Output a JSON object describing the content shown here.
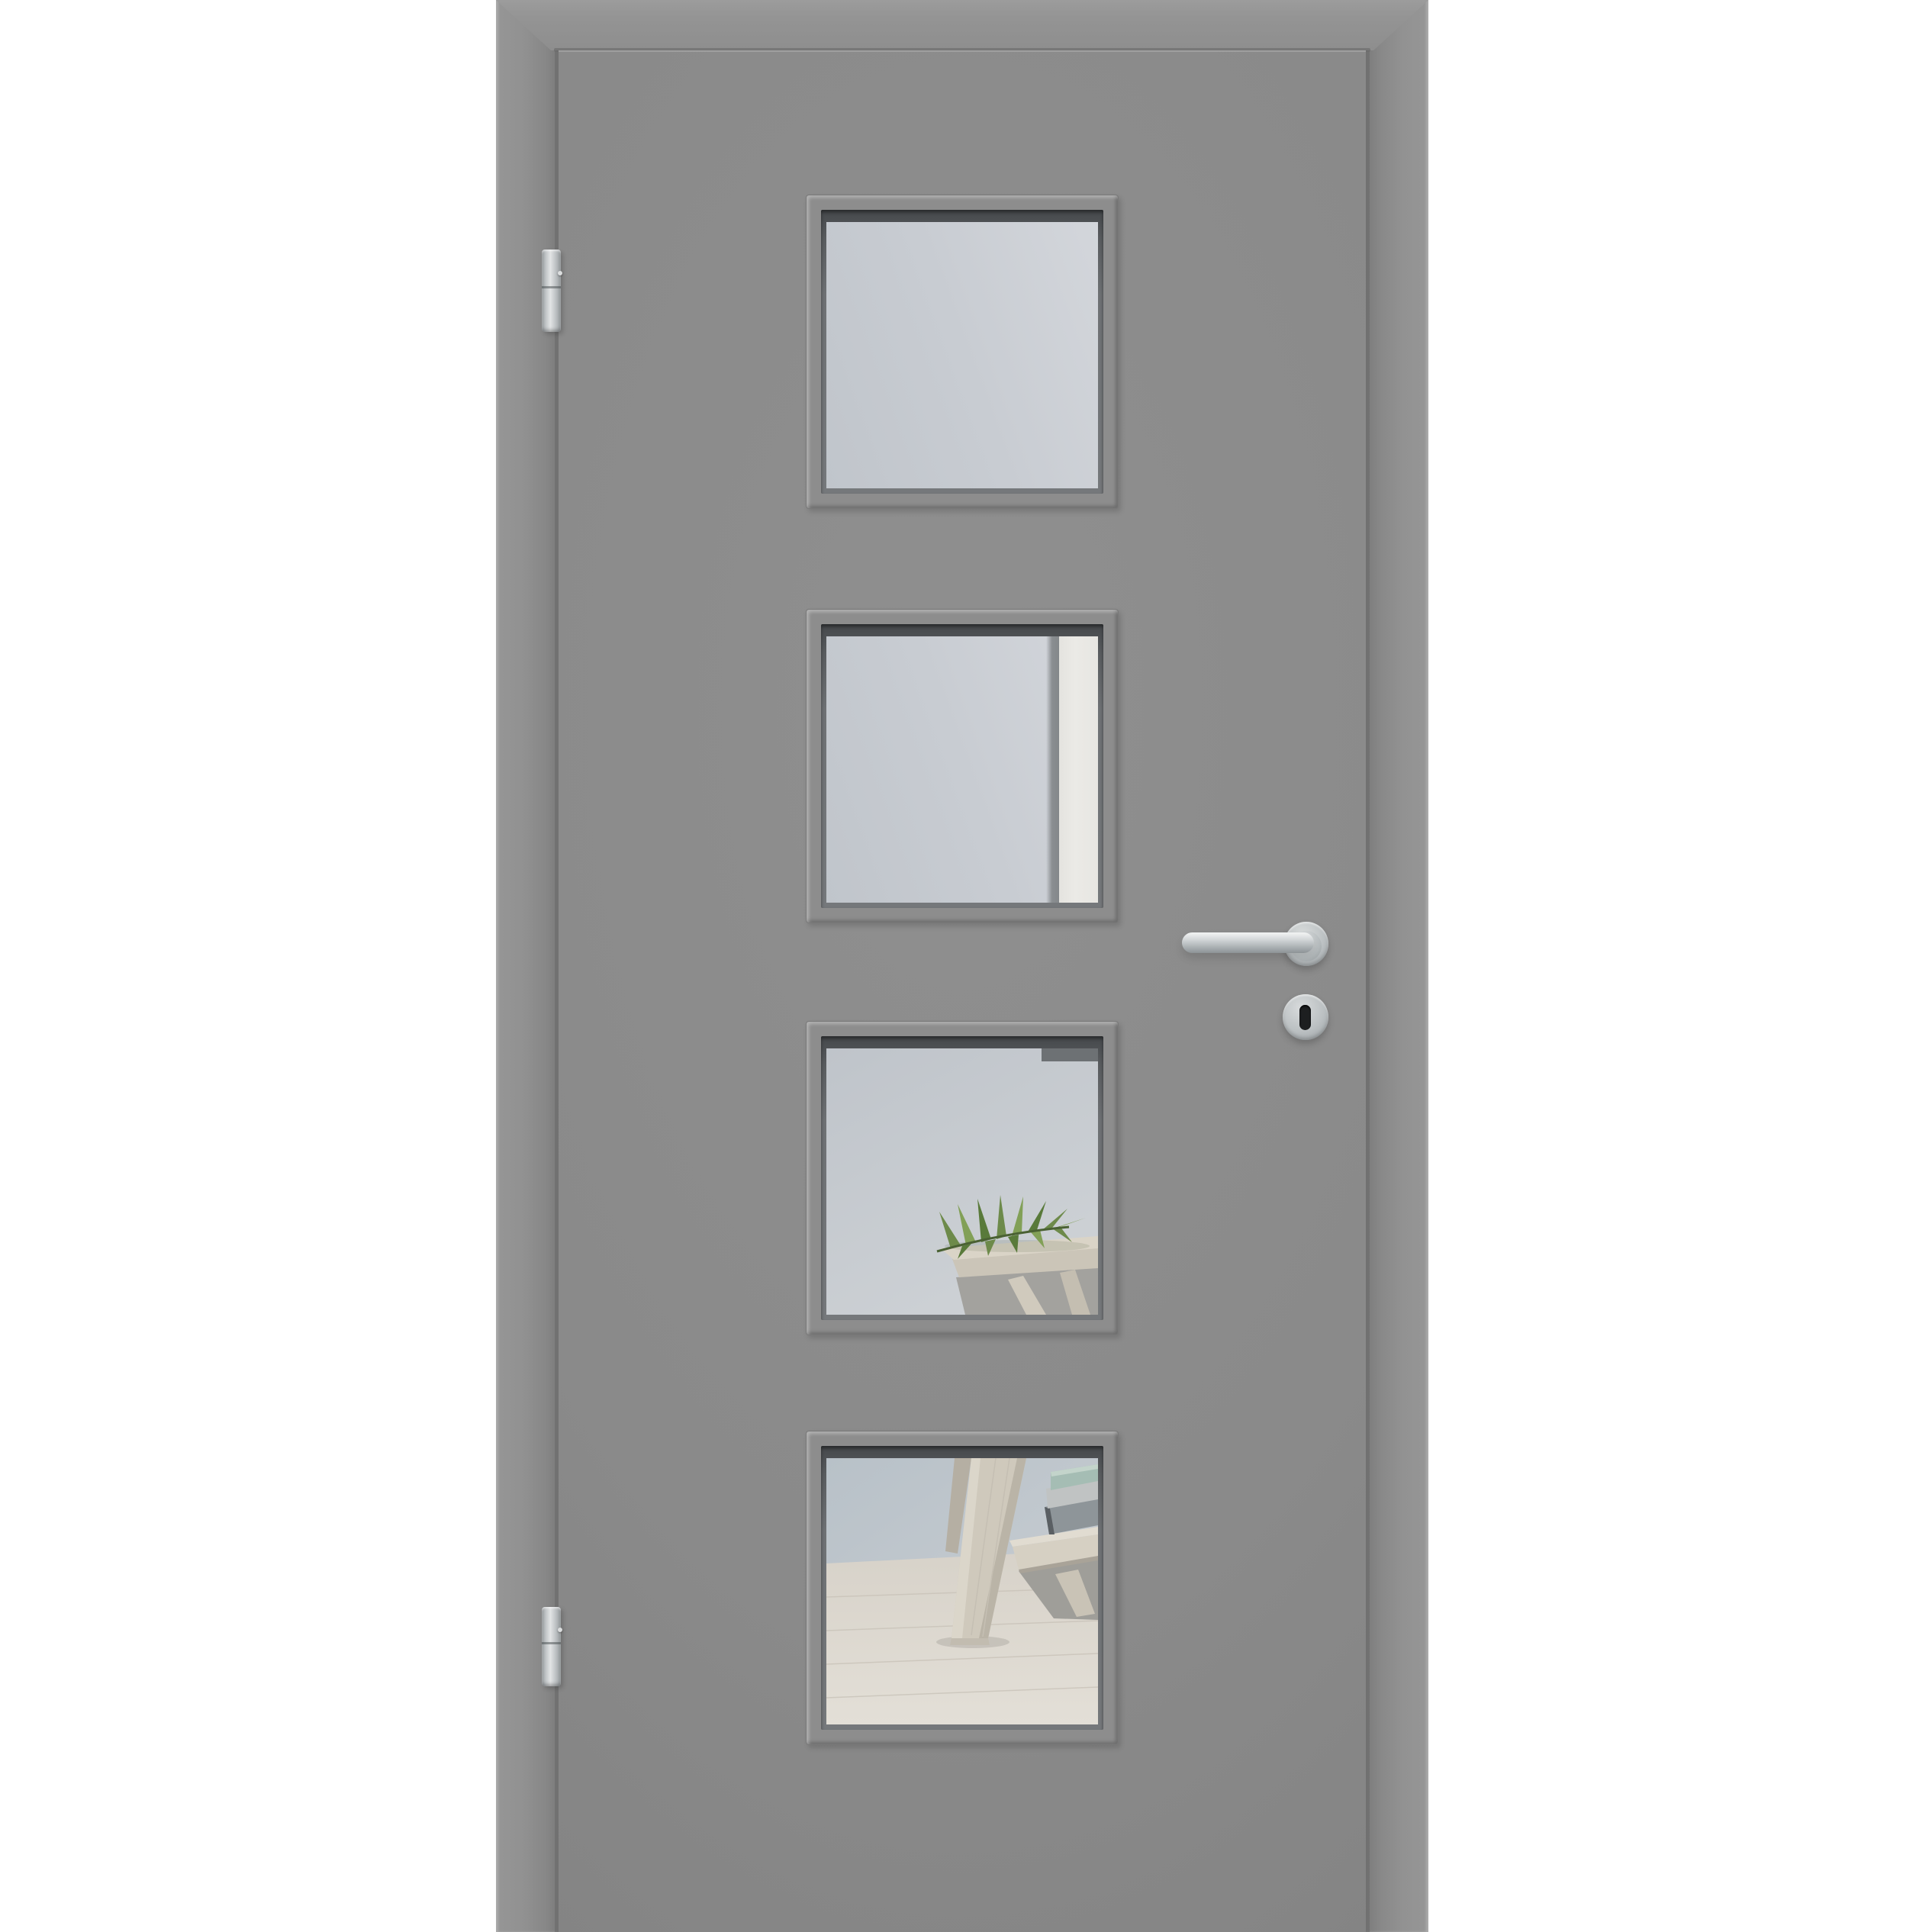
{
  "scene": {
    "type": "product-photo",
    "subject": "Grey interior door with frame, four square glass cut-outs, stainless lever handle and two barrel hinges",
    "pane_count": 4,
    "hinge_count": 2
  },
  "door": {
    "leaf": "grey lacquered door leaf",
    "frame": "grey door frame with mitred top corners",
    "panes": [
      {
        "id": 1,
        "reflection": "frosted light-grey glass"
      },
      {
        "id": 2,
        "reflection": "frosted glass with bright white wall strip on the right"
      },
      {
        "id": 3,
        "reflection": "room reflection: light wall, side table with green palm leaf"
      },
      {
        "id": 4,
        "reflection": "room reflection: pale wood floor, trestle table leg, shelf with books"
      }
    ],
    "hardware": {
      "handle": "stainless steel L-form lever on round rose",
      "lock": "round escutcheon with keyhole",
      "hinges": "two satin barrel hinges on left edge"
    }
  },
  "colors": {
    "bg": "#ffffff",
    "frame-gray": "#929292",
    "frame-gray-dark": "#7e7e7e",
    "door-gray": "#8a8a8a",
    "door-gray-light": "#8f8f8f",
    "door-gray-dark": "#7f7f7f",
    "seam-gray": "#6b6b6b",
    "bead-gray": "#8d8d8d",
    "recess-dark": "#4f5254",
    "glass-light": "#d3d6db",
    "glass-mid": "#c8ccd2",
    "glass-deep": "#c0c5cb",
    "reflect-white": "#ebeae6",
    "reflect-gray-strip": "#8a8e91",
    "wall-blue": "#b9c2c9",
    "wall-blue-light": "#ccd0d4",
    "dark-object": "#6d7174",
    "wood-light": "#dcd7ce",
    "wood-mid": "#cfc9bc",
    "wood-dark": "#b5afa3",
    "wood-shadow": "#a09f9b",
    "leaf-green": "#6d8a4a",
    "leaf-green-dark": "#597a3a",
    "leaf-green-light": "#82a057",
    "book-teal": "#a5bdb4",
    "book-gray": "#c0c3c3",
    "book-slate": "#8e9599",
    "book-spine": "#5a5f63",
    "metal-light": "#e6e8e9",
    "metal-mid": "#c0c5c7",
    "metal-dark": "#92989b",
    "keyhole-black": "#1d1f20"
  }
}
